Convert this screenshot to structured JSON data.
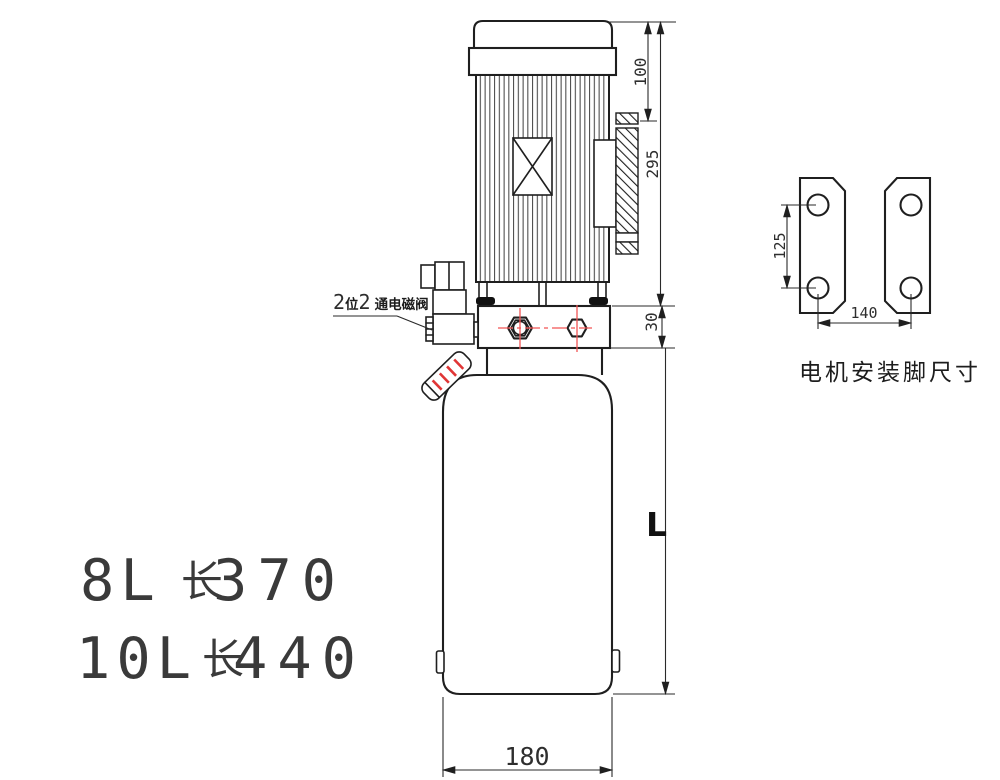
{
  "drawing": {
    "type": "hydraulic-power-unit-technical-drawing",
    "colors": {
      "line": "#1f1f1f",
      "centerline": "#f25555",
      "text": "#3a3a3a"
    },
    "dimensions": {
      "motor_top_to_terminal_box": "100",
      "motor_overall_height": "295",
      "valve_block_height": "30",
      "tank_length_variable": "L",
      "tank_width": "180",
      "foot_hole_spacing": "125",
      "foot_hole_span": "140"
    },
    "labels": {
      "solenoid_part1": "2",
      "solenoid_part2": "位",
      "solenoid_part3": "2",
      "solenoid_part4": "通电磁阀",
      "feet_caption": "电机安装脚尺寸",
      "spec1_capacity": "8L",
      "spec1_len_char": "长",
      "spec1_value": "370",
      "spec2_capacity": "10L",
      "spec2_len_char": "长",
      "spec2_value": "440"
    }
  }
}
